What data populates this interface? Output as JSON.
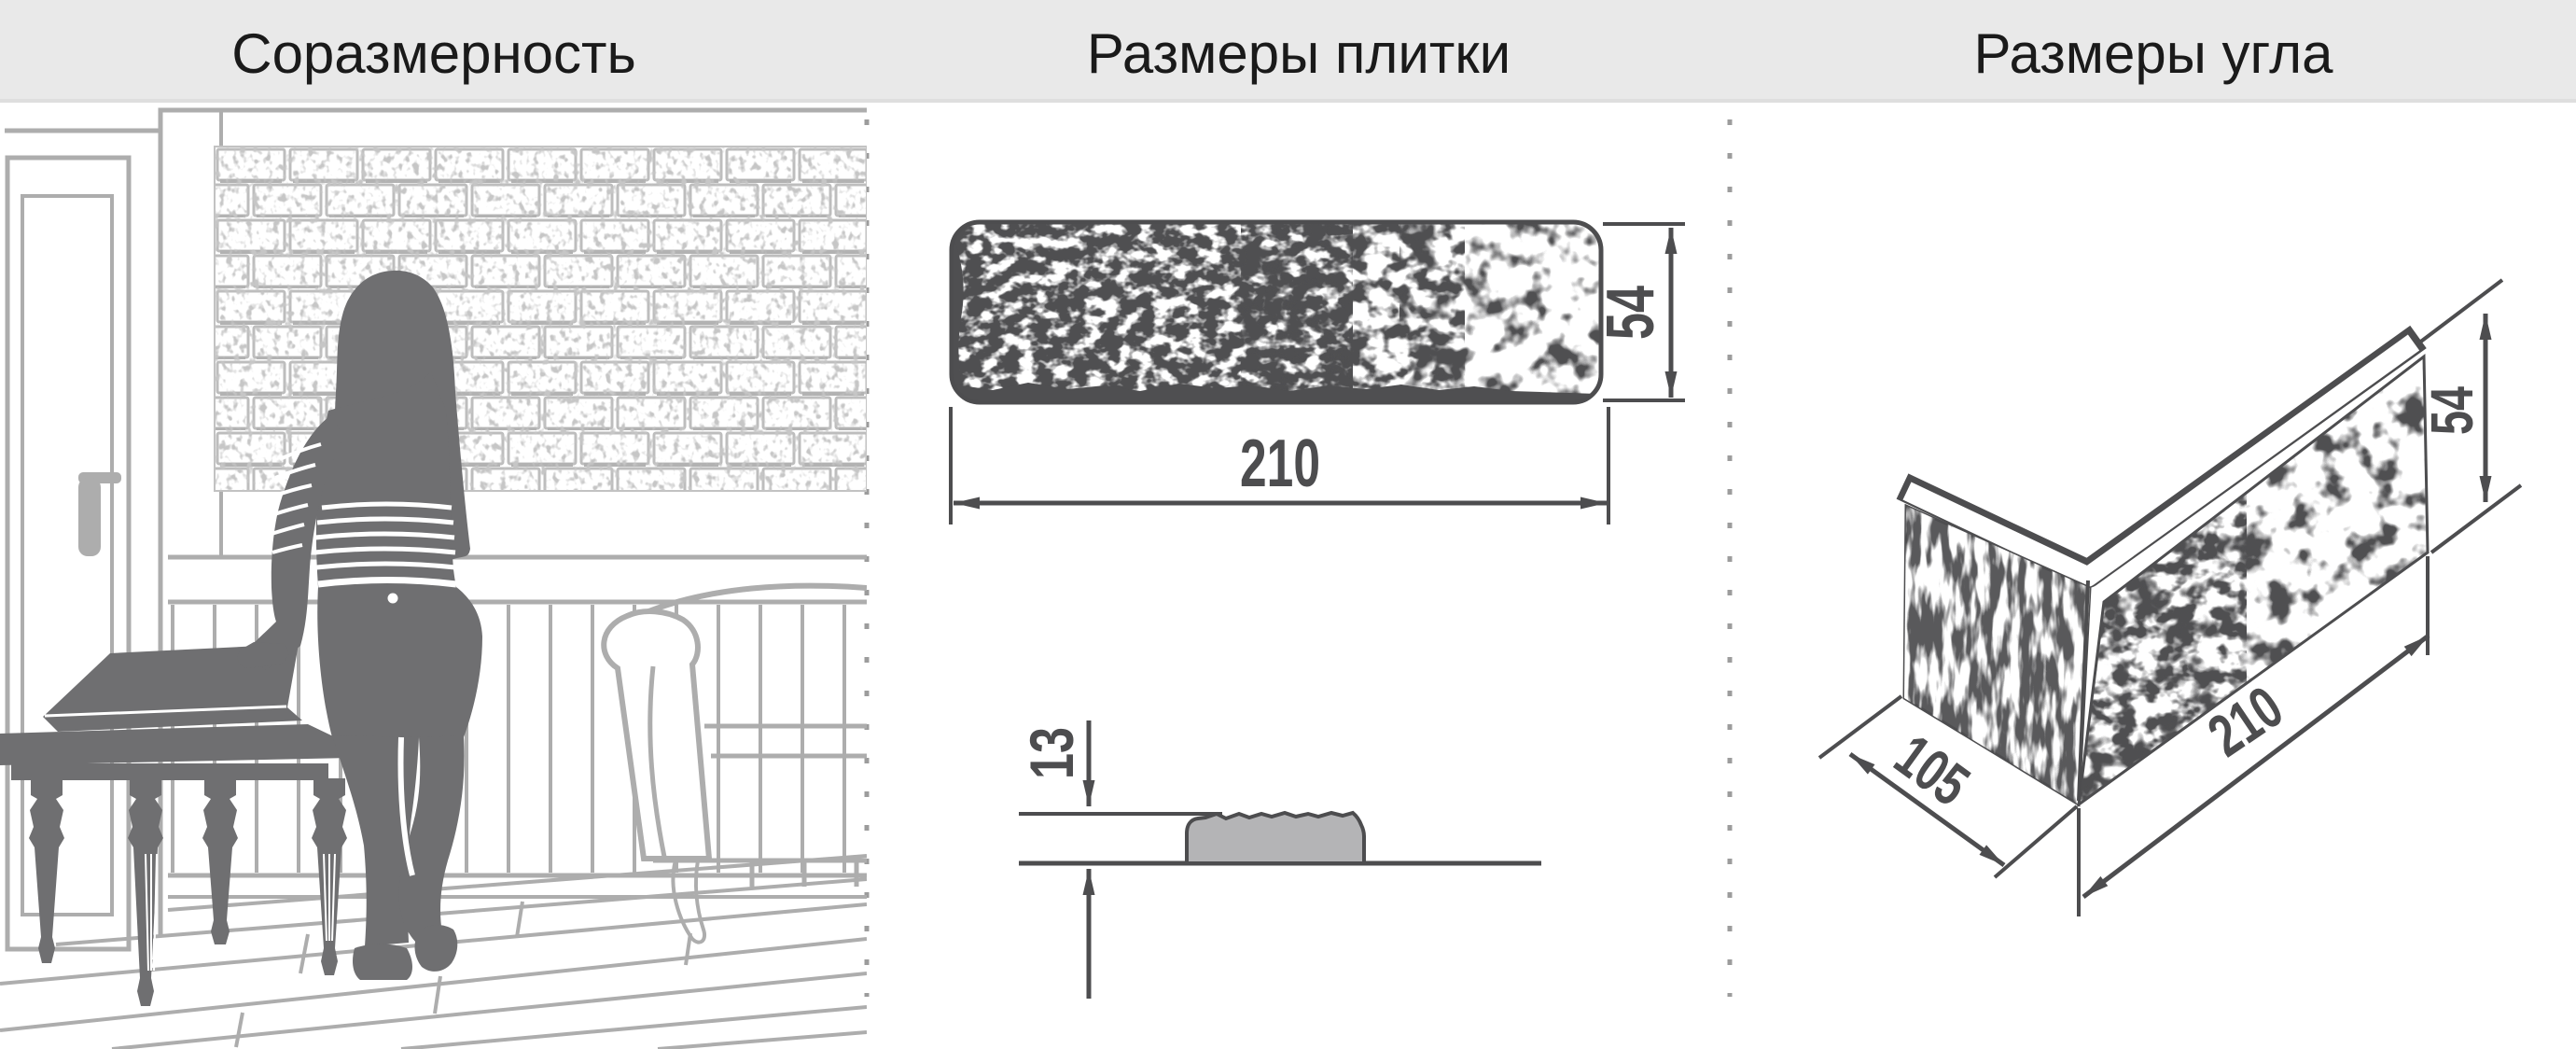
{
  "header": {
    "sections": [
      {
        "title": "Соразмерность"
      },
      {
        "title": "Размеры плитки"
      },
      {
        "title": "Размеры угла"
      }
    ]
  },
  "tile_front": {
    "width": "210",
    "height": "54"
  },
  "tile_profile": {
    "thickness": "13"
  },
  "corner_piece": {
    "depth": "105",
    "length": "210",
    "height": "54"
  },
  "colors": {
    "header_bg": "#e9e9e9",
    "title_text": "#1a1a1a",
    "drawing_dark": "#4d4d4f",
    "silhouette_gray": "#6f6f71",
    "room_outline_gray": "#adadad",
    "brick_mortar_gray": "#bdbdbd",
    "profile_fill_gray": "#b4b4b6",
    "divider_dot_gray": "#9c9c9c"
  }
}
